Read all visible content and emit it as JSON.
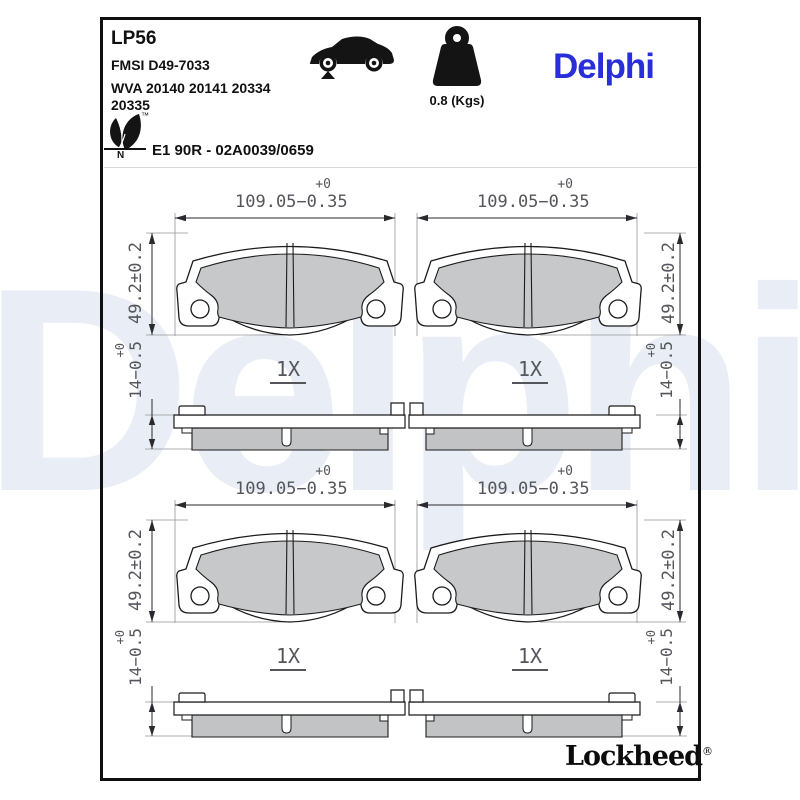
{
  "header": {
    "part_number": "LP56",
    "fmsi": "FMSI D49-7033",
    "wva": "WVA 20140 20141 20334\n20335",
    "weight_label": "0.8 (Kgs)",
    "brand": "Delphi",
    "approval": "E1 90R - 02A0039/0659",
    "eco_tm": "™",
    "eco_letter": "N"
  },
  "drawing": {
    "width_dim_plus": "+0",
    "width_dim": "109.05−0.35",
    "height_dim": "49.2±0.2",
    "thickness_dim_plus": "+0",
    "thickness_dim": "14−0.5",
    "quantity": "1X"
  },
  "watermark": "Delphi",
  "footer": {
    "brand": "Lockheed",
    "registered": "®"
  },
  "colors": {
    "brand_blue": "#282ED8",
    "friction_gray": "#C7C8CA",
    "watermark": "#E9EDF5"
  }
}
